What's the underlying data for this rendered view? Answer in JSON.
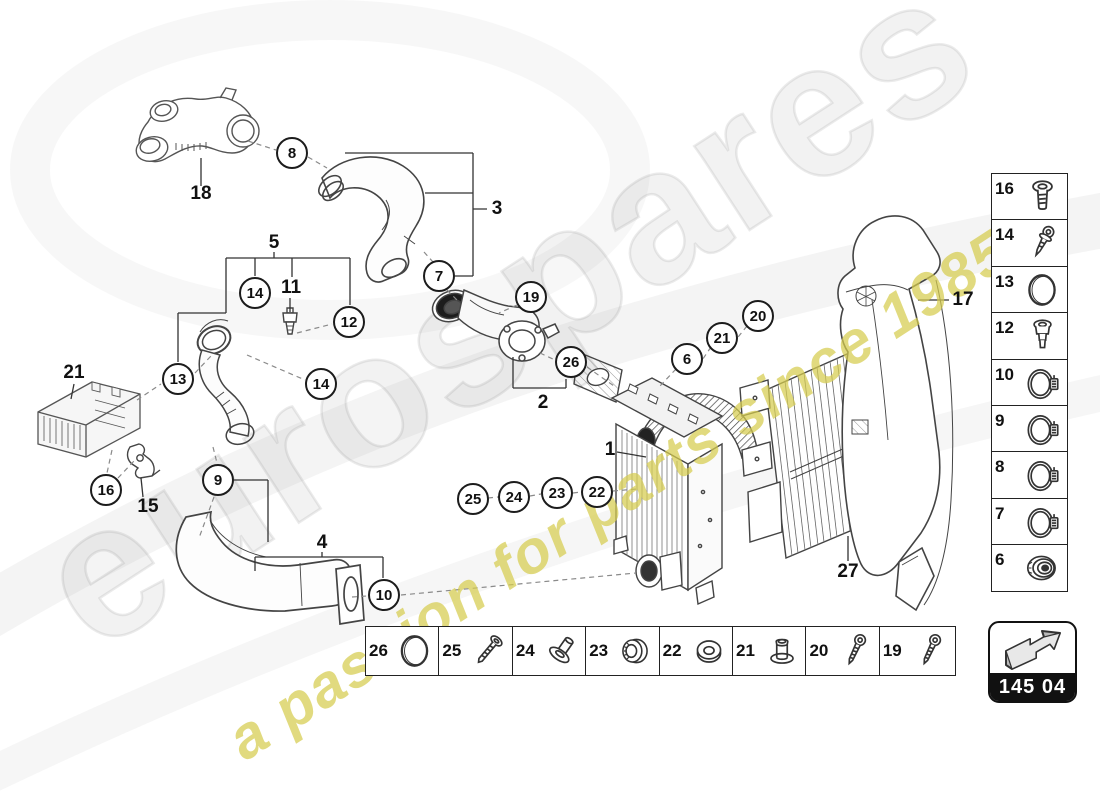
{
  "meta": {
    "page_code": "145 04"
  },
  "watermark": {
    "brand": "eurospares",
    "tagline": "a passion for parts since 1985",
    "brand_color": "#bdbdbd",
    "tagline_color": "#d6cc4e"
  },
  "callouts": {
    "circles": [
      {
        "label": "8"
      },
      {
        "label": "7"
      },
      {
        "label": "19"
      },
      {
        "label": "14"
      },
      {
        "label": "12"
      },
      {
        "label": "13"
      },
      {
        "label": "14"
      },
      {
        "label": "26"
      },
      {
        "label": "6"
      },
      {
        "label": "21"
      },
      {
        "label": "20"
      },
      {
        "label": "16"
      },
      {
        "label": "9"
      },
      {
        "label": "10"
      },
      {
        "label": "25"
      },
      {
        "label": "24"
      },
      {
        "label": "23"
      },
      {
        "label": "22"
      }
    ],
    "plain": [
      {
        "label": "18"
      },
      {
        "label": "3"
      },
      {
        "label": "5"
      },
      {
        "label": "11"
      },
      {
        "label": "21"
      },
      {
        "label": "15"
      },
      {
        "label": "4"
      },
      {
        "label": "2"
      },
      {
        "label": "1"
      },
      {
        "label": "17"
      },
      {
        "label": "27"
      }
    ]
  },
  "sidebar": {
    "items": [
      {
        "label": "16",
        "icon": "flanged-screw"
      },
      {
        "label": "14",
        "icon": "tapping-screw"
      },
      {
        "label": "13",
        "icon": "o-ring"
      },
      {
        "label": "12",
        "icon": "plastic-rivet"
      },
      {
        "label": "10",
        "icon": "hose-clamp"
      },
      {
        "label": "9",
        "icon": "hose-clamp"
      },
      {
        "label": "8",
        "icon": "hose-clamp"
      },
      {
        "label": "7",
        "icon": "hose-clamp"
      },
      {
        "label": "6",
        "icon": "grommet-bearing"
      }
    ]
  },
  "bottom_strip": {
    "items": [
      {
        "label": "26",
        "icon": "o-ring"
      },
      {
        "label": "25",
        "icon": "long-bolt"
      },
      {
        "label": "24",
        "icon": "flat-head-bolt"
      },
      {
        "label": "23",
        "icon": "sealing-cap"
      },
      {
        "label": "22",
        "icon": "washer"
      },
      {
        "label": "21",
        "icon": "blind-rivet"
      },
      {
        "label": "20",
        "icon": "pan-head-screw"
      },
      {
        "label": "19",
        "icon": "pan-head-screw"
      }
    ]
  }
}
